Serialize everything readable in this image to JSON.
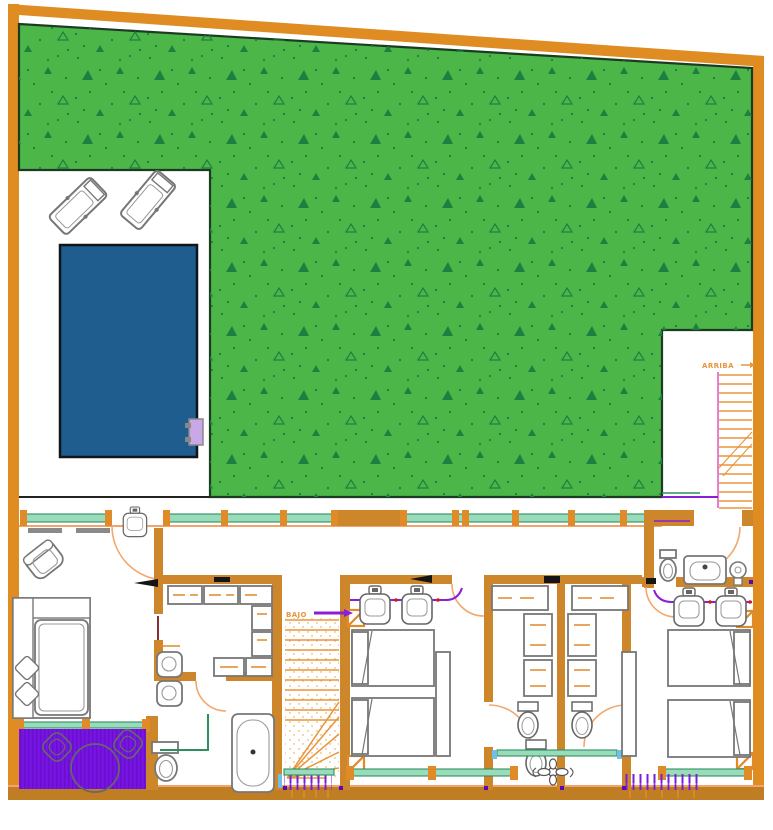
{
  "floor_plan": {
    "labels": {
      "stairs_up": "ARRIBA",
      "stairs_down": "BAJO"
    },
    "colors": {
      "boundary_wall": "#DF8C22",
      "interior_wall": "#CE862A",
      "bottom_wall": "#C07E24",
      "grass": "#4CB648",
      "grass_specks": "#1D8040",
      "pool_water": "#1E5D8E",
      "terrace_deck": "#7713E3",
      "terrace_stripe": "#5C0BB8",
      "plumbing_line": "#8A1FD8",
      "window_glazing": "#9ADBBC",
      "window_frame": "#2F8F5F",
      "door_swing": "#F2A86C",
      "stair_treads": "#E8953A",
      "handrail_magenta": "#E060C0",
      "furniture_outline": "#777777",
      "site_outline": "#1B3B22",
      "pool_ladder": "#C9A8E8",
      "accent_lightblue": "#6EC0E8",
      "accent_maroon": "#8B3030",
      "accent_red": "#CC2020"
    },
    "fixtures": [
      "swimming-pool",
      "sun-lounger",
      "pool-ladder",
      "staircase-up",
      "staircase-down",
      "armchair",
      "double-bed",
      "single-bed",
      "pillow",
      "wardrobe",
      "closet-shelving",
      "washbasin",
      "toilet",
      "bathtub",
      "shower-screen",
      "vanity-sink",
      "round-table",
      "garden-chair",
      "radiator",
      "window",
      "door-swing",
      "structural-column",
      "plant-ornament"
    ]
  }
}
